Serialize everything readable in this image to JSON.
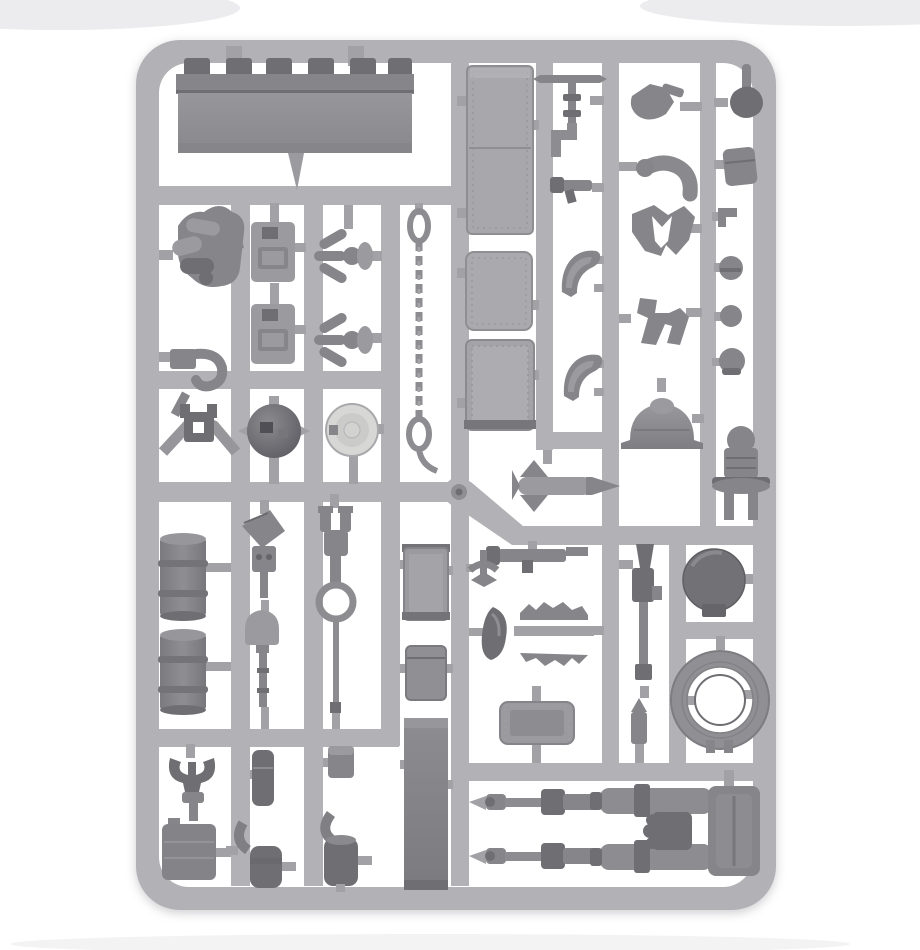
{
  "meta": {
    "subject": "Grey polystyrene model kit sprue photographed on a white background",
    "kit_style": "Tank accessory and crew sprue",
    "text_visible": "none"
  },
  "colors": {
    "background": "#ffffff",
    "sprue": "#b2b2b6",
    "sprue_dark": "#a2a2a6",
    "part_mid": "#9b9b9f",
    "part_dark": "#85858a",
    "part_darker": "#6f6f73",
    "dome_light": "#d7d7d5",
    "blade": "#929296"
  },
  "parts": {
    "frame": "Sprue frame with rounded corners",
    "hub": "Central injection gate hub",
    "dozer_blade": "Dozer blade with six hinge clips",
    "stowage_bundle": "Rolled stowage bundle",
    "tow_hook": "Stowage hook",
    "pintle_mount": "Pintle mount bracket",
    "jerry_can_1": "Jerry can",
    "jerry_can_2": "Jerry can",
    "grapnel_1": "Three-pronged grapnel",
    "grapnel_2": "Three-pronged grapnel",
    "tow_chain": "Tow chain with shackle ends",
    "helmet_dome": "Dark domed helmet",
    "hatch_wheel": "Light round hatch wheel",
    "box_long": "Long riveted stowage box",
    "box_a": "Riveted stowage box",
    "box_b": "Riveted stowage box",
    "periscope": "Periscope aerial with elbow pipe",
    "pistol": "Pistol",
    "crest_a": "Winged crest",
    "crest_b": "Winged crest",
    "arm_pistol": "Crew arm holding pistol",
    "arm_bent": "Bent crew arm",
    "torso": "Crew torso with arms",
    "legs": "Crew legs",
    "searchlight": "Searchlight bell housing",
    "fist_grip": "Fist gripping stick",
    "pouch_flap": "Equipment pouch",
    "fitting_small": "Small fitting",
    "head_1": "Crew head",
    "head_2": "Crew head",
    "head_stalk": "Crew head on stalk",
    "cupola": "Commander cupola with legs",
    "missile": "Finned missile",
    "boltgun": "Boltgun",
    "aquila_tip": "Winged finial",
    "canister_curved": "Curved canister",
    "spiked_trim": "Spiked trim strips",
    "riveted_plate": "Riveted access plate",
    "lasgun": "Lasgun",
    "shell": "Shell round",
    "round_hatch": "Dark round hatch plate",
    "cable_coil": "Coiled tow cable",
    "drum_1": "Fuel drum",
    "drum_2": "Fuel drum",
    "mattock": "Entrenching tool head",
    "shovel": "Shovel",
    "breach_tool": "Tool shaft with towing ring",
    "box_c": "Riveted stowage box",
    "ammo_box": "Ammunition box",
    "armour_panel": "Tall armour panel",
    "shackle_u": "Towing shackle",
    "fuel_can": "Flat fuel can",
    "pouch_tall": "Tall pouch",
    "box_small": "Small stowage box",
    "tank_fitting_1": "Canister with elbow pipe",
    "tank_fitting_2": "Canister with elbow pipe",
    "barrel_a": "Telescoped gun barrel",
    "barrel_b": "Telescoped gun barrel",
    "twin_gun": "Twin-linked gun assembly"
  }
}
